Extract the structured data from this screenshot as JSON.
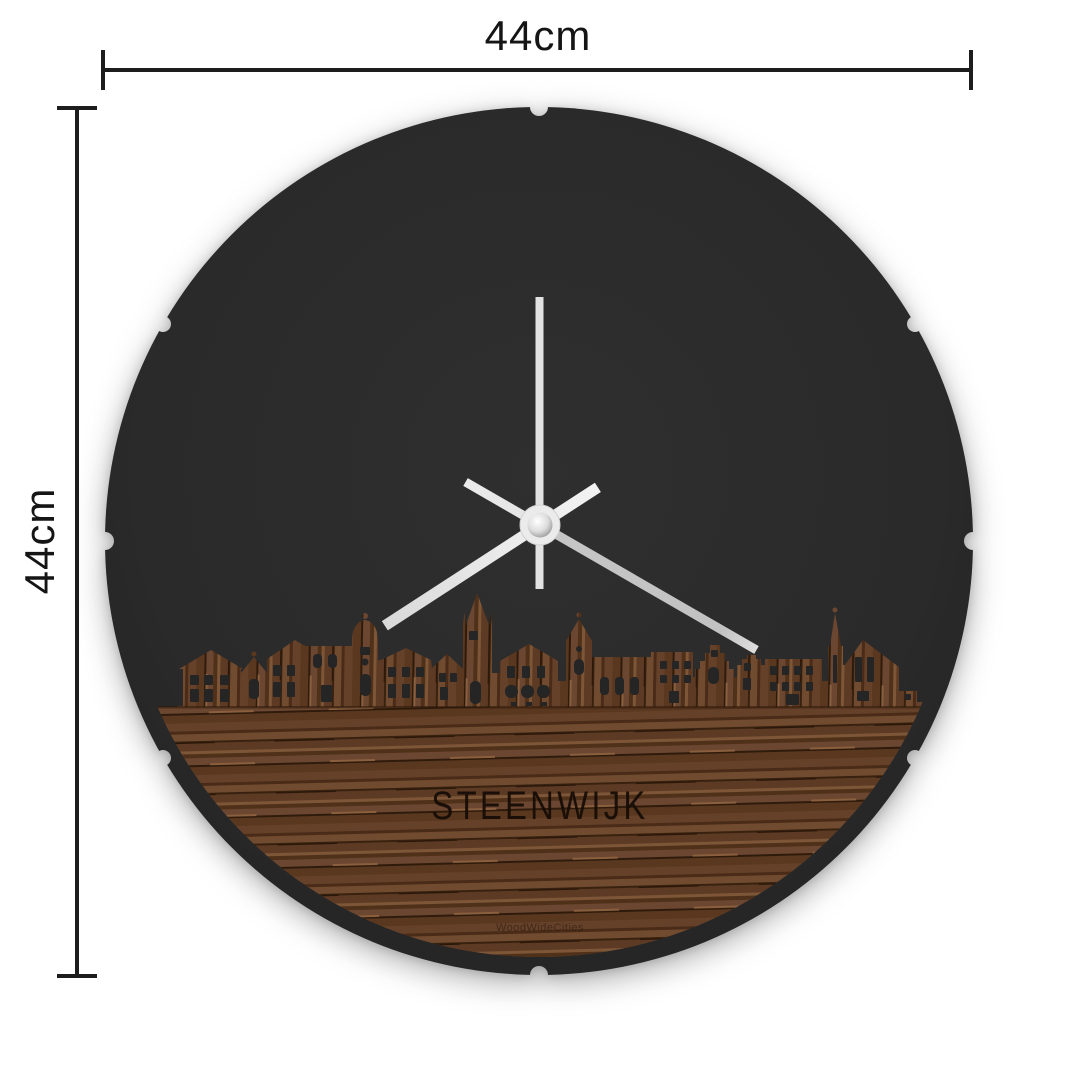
{
  "dimensions": {
    "width": {
      "label": "44cm"
    },
    "height": {
      "label": "44cm"
    }
  },
  "clock": {
    "city": "STEENWIJK",
    "watermark": "WoodWideCities",
    "colors": {
      "backboard": "#2a2a2a",
      "wood_mid": "#66412a",
      "wood_dark": "#38220f",
      "wood_light": "#7d5638",
      "hands": "#ececec"
    }
  }
}
